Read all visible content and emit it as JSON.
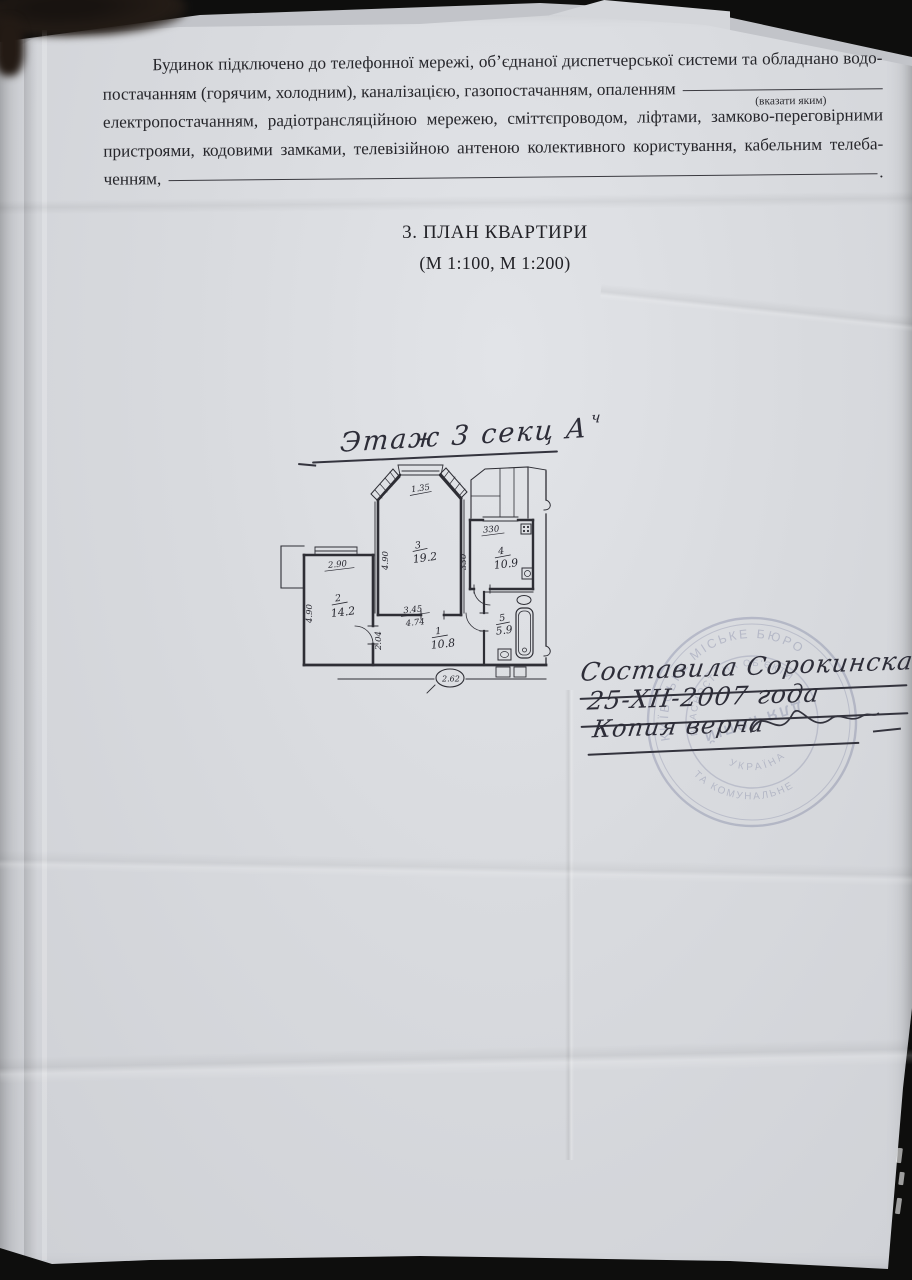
{
  "page": {
    "paragraph": {
      "line1": "Будинок підключено до телефонної мережі, об’єднаної диспетчерської системи та обладнано водо-",
      "line2": "постачанням (горячим, холодним), каналізацією, газопостачанням, опаленням",
      "line2_hint": "(вказати яким)",
      "line3": "електропостачанням, радіотрансляційною мережею, сміттєпроводом, ліфтами, замково-переговірними",
      "line4": "пристроями, кодовими замками, телевізійною антеною колективного користування, кабельним телеба-",
      "line5": "ченням,",
      "line5_period": "."
    },
    "heading": {
      "title": "3. ПЛАН КВАРТИРИ",
      "scale": "(М 1:100, М 1:200)"
    },
    "plan_title": {
      "text": "Этаж 3 секц А",
      "sup": "ч"
    },
    "floor_plan": {
      "rooms": {
        "r1": {
          "num": "1",
          "area": "10.8"
        },
        "r2": {
          "num": "2",
          "area": "14.2"
        },
        "r3": {
          "num": "3",
          "area": "19.2"
        },
        "r4": {
          "num": "4",
          "area": "10.9"
        },
        "r5": {
          "num": "5",
          "area": "5.9"
        }
      },
      "dims": {
        "bay_window": "1.35",
        "room3_depth": "4.90",
        "room2_width": "2.90",
        "room2_depth": "4.90",
        "room4_width": "330",
        "room4_depth": "330",
        "hall_a": "3.45",
        "hall_b": "4.74",
        "hall_left": "2.04",
        "oval": "2.62"
      }
    },
    "handwriting": {
      "line1": "Составила Сорокинская",
      "line2": "25-ХІІ-2007 года",
      "line3": "Копия верна"
    },
    "stamp": {
      "arc_outer_top": "КИЇВСЬКЕ МІСЬКЕ БЮРО",
      "arc_inner_top": "ВЛАСНОСТІ НА ОБ'ЄКТИ",
      "arc_outer_bottom": "ТА КОМУНАЛЬНЕ",
      "arc_inner_bottom": "УКРАЇНА",
      "center": "ДЛЯ КОПІЙ"
    }
  }
}
